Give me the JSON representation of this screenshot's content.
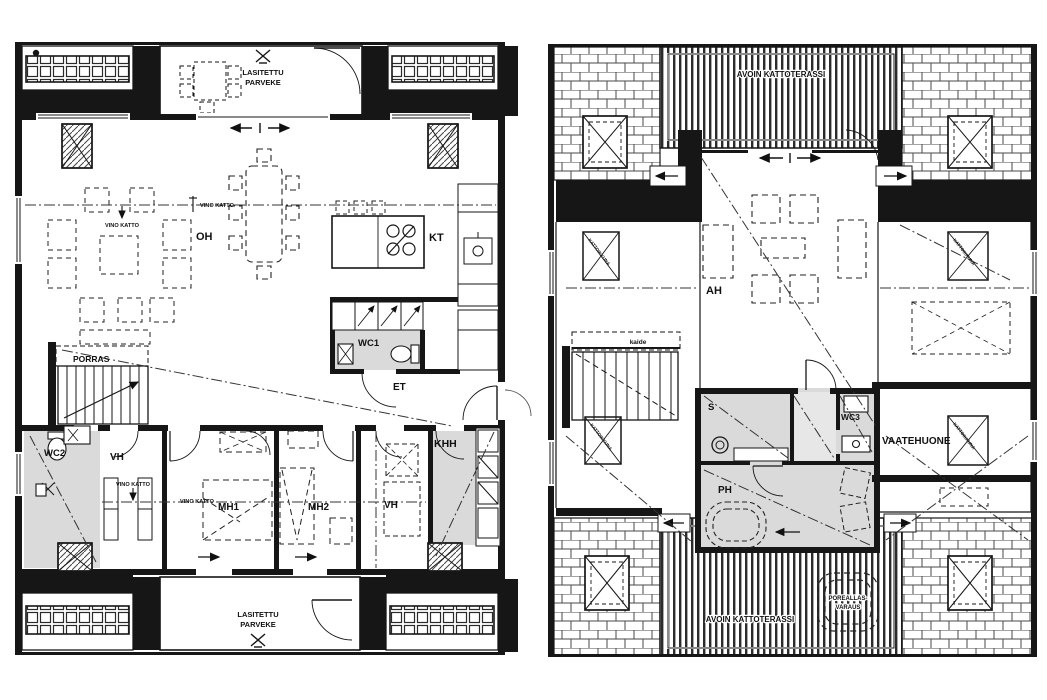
{
  "page": {
    "background": "#ffffff"
  },
  "colors": {
    "wall": "#161616",
    "line": "#333333",
    "wet_room_fill": "#dadada",
    "light_fill": "#e7e7e7"
  },
  "floorplan_lower": {
    "name": "lower-floor-plan",
    "glazed_balcony": {
      "line1": "LASITETTU",
      "line2": "PARVEKE"
    },
    "rooms": {
      "oh": "OH",
      "kt": "KT",
      "wc1": "WC1",
      "et": "ET",
      "porras": "PORRAS",
      "wc2": "WC2",
      "vh": "VH",
      "mh1": "MH1",
      "mh2": "MH2",
      "vh2": "VH",
      "khh": "KHH"
    },
    "annotations": {
      "vino_katto": "VINO KATTO"
    }
  },
  "floorplan_upper": {
    "name": "upper-floor-plan",
    "roof_terrace": "AVOIN KATTOTERASSI",
    "rooms": {
      "ah": "AH",
      "s": "S",
      "wc3": "WC3",
      "ph": "PH",
      "vaatehuone": "VAATEHUONE"
    },
    "annotations": {
      "kaide": "kaide",
      "poreallas_line1": "POREALLAS-",
      "poreallas_line2": "VARAUS",
      "kattoikkuna": "KATTOIKKUNA"
    }
  }
}
